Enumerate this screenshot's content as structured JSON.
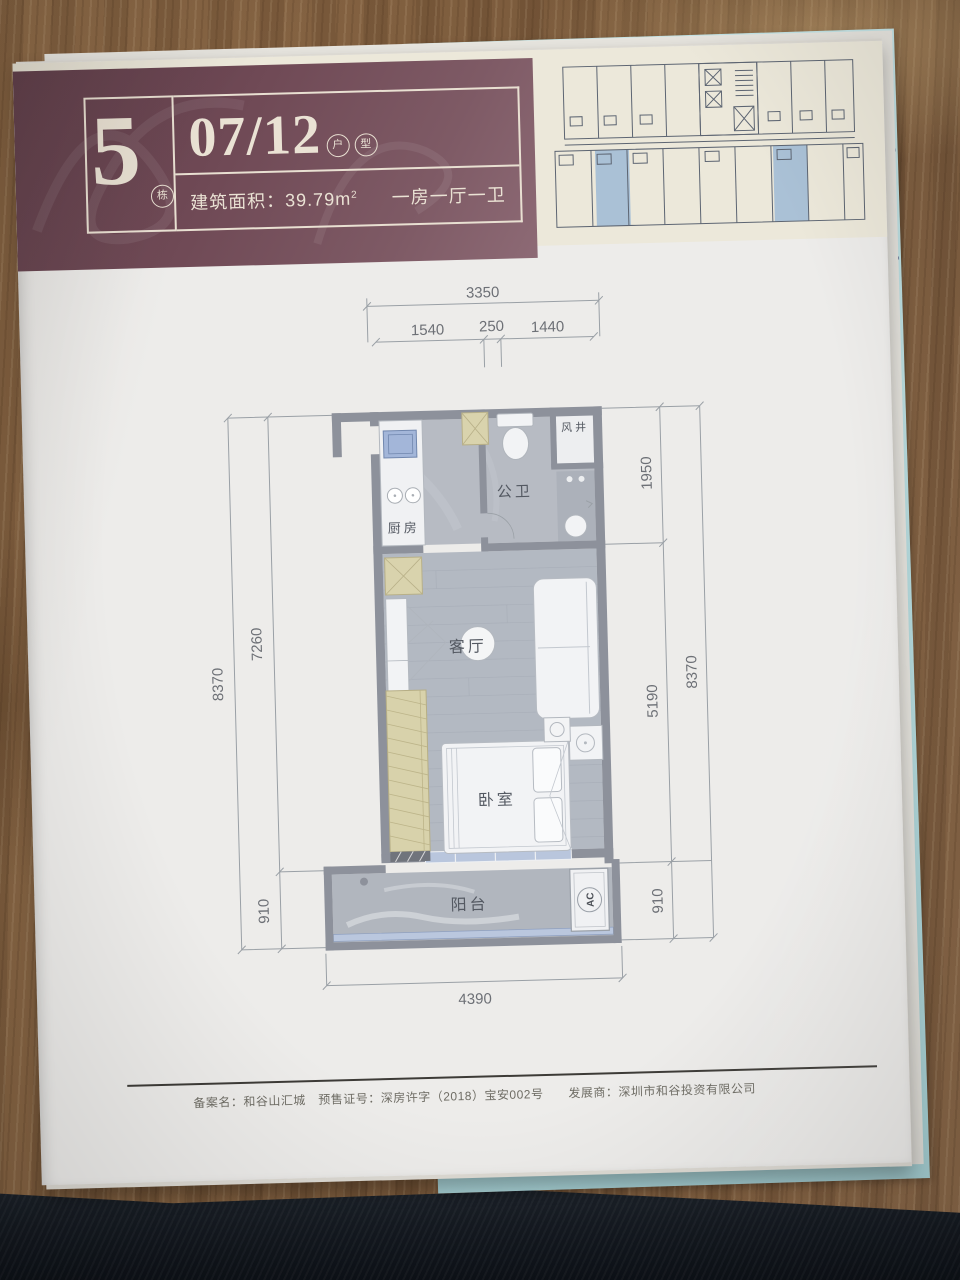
{
  "colors": {
    "brand_maroon": "#6f4955",
    "page_cream": "#ece8da",
    "keyplan_highlight": "#aac1d6",
    "underpage_teal": "#b5dadd",
    "plan_wall": "#8d919b"
  },
  "page": {
    "header": {
      "building_number": "5",
      "building_unit_label": "栋",
      "unit_code": "07/12",
      "unit_char_1": "户",
      "unit_char_2": "型",
      "area_text": "建筑面积：39.79m",
      "area_exponent": "2",
      "layout_text": "一房一厅一卫"
    },
    "plan": {
      "rooms": {
        "kitchen": "厨房",
        "bathroom": "公卫",
        "shaft": "风井",
        "living": "客厅",
        "bedroom": "卧室",
        "balcony": "阳台",
        "ac": "AC"
      },
      "dims": {
        "top_total": "3350",
        "top_seg1": "1540",
        "top_seg2": "250",
        "top_seg3": "1440",
        "left_outer": "8370",
        "left_inner_main": "7260",
        "left_inner_balcony": "910",
        "right_inner_top": "1950",
        "right_inner_mid": "5190",
        "right_inner_bottom": "910",
        "right_outer": "8370",
        "bottom_total": "4390"
      }
    },
    "footer": {
      "disclaimer": "备案名：和谷山汇城　预售证号：深房许字（2018）宝安002号　　发展商：深圳市和谷投资有限公司"
    }
  }
}
